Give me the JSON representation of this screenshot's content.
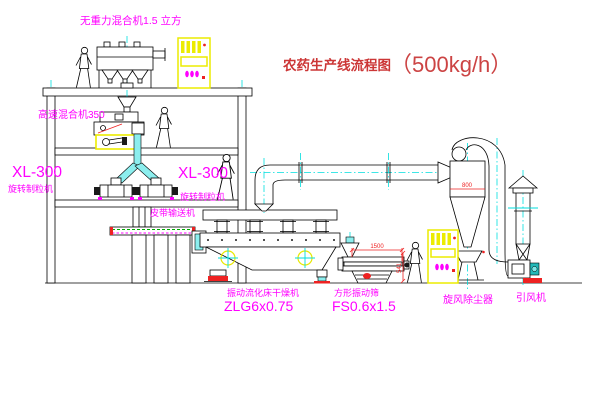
{
  "title": {
    "text": "农药生产线流程图",
    "capacity": "（500kg/h）"
  },
  "equipment_labels": {
    "gravity_mixer": "无重力混合机1.5 立方",
    "high_speed_mixer": "高速混合机350",
    "granulator_left_model": "XL-300",
    "granulator_left_name": "旋转制粒机",
    "granulator_right_model": "XL-300",
    "granulator_right_name": "旋转制粒机",
    "belt_conveyor": "皮带输送机",
    "fluid_bed_dryer_name": "振动流化床干燥机",
    "fluid_bed_dryer_model": "ZLG6x0.75",
    "vibrating_sieve_name": "方形振动筛",
    "vibrating_sieve_model": "FS0.6x1.5",
    "cyclone_collector": "旋风除尘器",
    "induced_draft_fan": "引风机"
  },
  "dimensions": {
    "sieve_length": "1500",
    "sieve_height": "541",
    "cyclone_diameter": "800"
  },
  "colors": {
    "line": "#000000",
    "centerline": "#00dede",
    "label_magenta": "#ff00ff",
    "title_red": "#cc3636",
    "dimension_red": "#ee2222",
    "highlight_yellow": "#ecec00",
    "conveyor_green": "#00aa00",
    "background": "#ffffff"
  }
}
